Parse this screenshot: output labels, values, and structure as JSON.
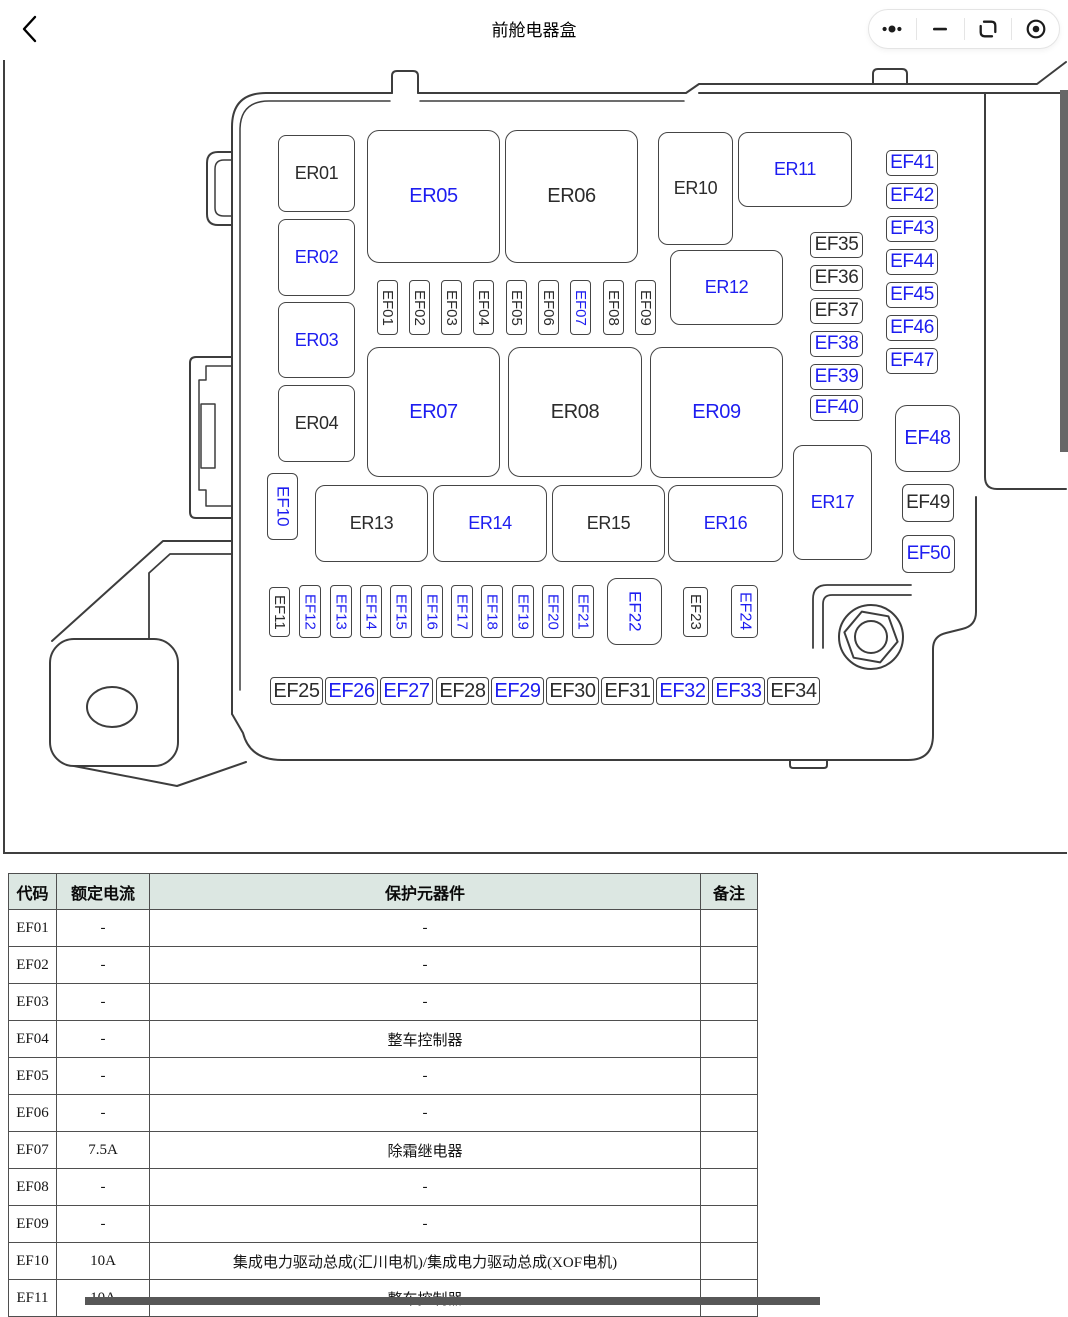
{
  "header": {
    "title": "前舱电器盒",
    "back_icon": "chevron-left",
    "capsule_icons": [
      "more-dots",
      "minimize",
      "restore-window",
      "circle-dot"
    ]
  },
  "colors": {
    "accent_blue": "#1d1df0",
    "label_black": "#2b2b2b",
    "outline": "#3d3d3d",
    "table_border": "#4f4f4f",
    "table_header_bg": "#dce7e2",
    "scrollbar": "#676767"
  },
  "diagram": {
    "description": "front-cabin fuse box line drawing with labeled relays and fuses",
    "component_fields": [
      "label",
      "x",
      "y",
      "w",
      "h",
      "color(b=blue,k=black)",
      "orientation(h/v)",
      "font_size",
      "corner_radius"
    ],
    "components": [
      [
        "ER01",
        278,
        135,
        77,
        77,
        "k",
        "h",
        18,
        8
      ],
      [
        "ER02",
        278,
        219,
        77,
        77,
        "b",
        "h",
        18,
        8
      ],
      [
        "ER03",
        278,
        302,
        77,
        76,
        "b",
        "h",
        18,
        8
      ],
      [
        "ER04",
        278,
        385,
        77,
        77,
        "k",
        "h",
        18,
        8
      ],
      [
        "ER05",
        367,
        130,
        133,
        133,
        "b",
        "h",
        20,
        12
      ],
      [
        "ER06",
        505,
        130,
        133,
        133,
        "k",
        "h",
        20,
        12
      ],
      [
        "ER07",
        367,
        347,
        133,
        130,
        "b",
        "h",
        20,
        12
      ],
      [
        "ER08",
        508,
        347,
        134,
        130,
        "k",
        "h",
        20,
        12
      ],
      [
        "ER09",
        650,
        347,
        133,
        131,
        "b",
        "h",
        20,
        12
      ],
      [
        "ER10",
        658,
        132,
        75,
        113,
        "k",
        "h",
        18,
        10
      ],
      [
        "ER11",
        738,
        132,
        114,
        75,
        "b",
        "h",
        18,
        10
      ],
      [
        "ER12",
        670,
        250,
        113,
        75,
        "b",
        "h",
        18,
        10
      ],
      [
        "ER13",
        315,
        485,
        113,
        77,
        "k",
        "h",
        18,
        10
      ],
      [
        "ER14",
        433,
        485,
        114,
        77,
        "b",
        "h",
        18,
        10
      ],
      [
        "ER15",
        552,
        485,
        113,
        77,
        "k",
        "h",
        18,
        10
      ],
      [
        "ER16",
        668,
        485,
        115,
        77,
        "b",
        "h",
        18,
        10
      ],
      [
        "ER17",
        793,
        445,
        79,
        115,
        "b",
        "h",
        18,
        10
      ],
      [
        "EF01",
        377,
        280,
        21,
        55,
        "k",
        "v",
        15,
        4
      ],
      [
        "EF02",
        409,
        280,
        21,
        55,
        "k",
        "v",
        15,
        4
      ],
      [
        "EF03",
        441,
        280,
        21,
        55,
        "k",
        "v",
        15,
        4
      ],
      [
        "EF04",
        473,
        280,
        21,
        55,
        "k",
        "v",
        15,
        4
      ],
      [
        "EF05",
        506,
        280,
        21,
        55,
        "k",
        "v",
        15,
        4
      ],
      [
        "EF06",
        538,
        280,
        21,
        55,
        "k",
        "v",
        15,
        4
      ],
      [
        "EF07",
        570,
        280,
        21,
        55,
        "b",
        "v",
        15,
        4
      ],
      [
        "EF08",
        603,
        280,
        21,
        55,
        "k",
        "v",
        15,
        4
      ],
      [
        "EF09",
        635,
        280,
        21,
        55,
        "k",
        "v",
        15,
        4
      ],
      [
        "EF10",
        267,
        473,
        31,
        67,
        "b",
        "v",
        17,
        6
      ],
      [
        "EF11",
        269,
        587,
        21,
        50,
        "k",
        "v",
        15,
        4
      ],
      [
        "EF12",
        299,
        585,
        22,
        53,
        "b",
        "v",
        15,
        4
      ],
      [
        "EF13",
        330,
        585,
        22,
        53,
        "b",
        "v",
        15,
        4
      ],
      [
        "EF14",
        360,
        585,
        22,
        53,
        "b",
        "v",
        15,
        4
      ],
      [
        "EF15",
        390,
        585,
        22,
        53,
        "b",
        "v",
        15,
        4
      ],
      [
        "EF16",
        421,
        585,
        22,
        53,
        "b",
        "v",
        15,
        4
      ],
      [
        "EF17",
        451,
        585,
        22,
        53,
        "b",
        "v",
        15,
        4
      ],
      [
        "EF18",
        481,
        585,
        22,
        53,
        "b",
        "v",
        15,
        4
      ],
      [
        "EF19",
        512,
        585,
        22,
        53,
        "b",
        "v",
        15,
        4
      ],
      [
        "EF20",
        542,
        585,
        22,
        53,
        "b",
        "v",
        15,
        4
      ],
      [
        "EF21",
        572,
        585,
        22,
        53,
        "b",
        "v",
        15,
        4
      ],
      [
        "EF22",
        607,
        578,
        55,
        67,
        "b",
        "v",
        17,
        10
      ],
      [
        "EF23",
        683,
        587,
        25,
        50,
        "k",
        "v",
        15,
        4
      ],
      [
        "EF24",
        731,
        585,
        27,
        53,
        "b",
        "v",
        16,
        5
      ],
      [
        "EF25",
        270,
        677,
        53,
        28,
        "k",
        "h",
        20,
        4
      ],
      [
        "EF26",
        325,
        677,
        53,
        28,
        "b",
        "h",
        20,
        4
      ],
      [
        "EF27",
        380,
        677,
        53,
        28,
        "b",
        "h",
        20,
        4
      ],
      [
        "EF28",
        436,
        677,
        53,
        28,
        "k",
        "h",
        20,
        4
      ],
      [
        "EF29",
        491,
        677,
        53,
        28,
        "b",
        "h",
        20,
        4
      ],
      [
        "EF30",
        546,
        677,
        53,
        28,
        "k",
        "h",
        20,
        4
      ],
      [
        "EF31",
        601,
        677,
        53,
        28,
        "k",
        "h",
        20,
        4
      ],
      [
        "EF32",
        656,
        677,
        53,
        28,
        "b",
        "h",
        20,
        4
      ],
      [
        "EF33",
        712,
        677,
        53,
        28,
        "b",
        "h",
        20,
        4
      ],
      [
        "EF34",
        767,
        677,
        53,
        28,
        "k",
        "h",
        20,
        4
      ],
      [
        "EF35",
        810,
        232,
        53,
        26,
        "k",
        "h",
        19,
        5
      ],
      [
        "EF36",
        810,
        265,
        53,
        26,
        "k",
        "h",
        19,
        5
      ],
      [
        "EF37",
        810,
        298,
        53,
        26,
        "k",
        "h",
        19,
        5
      ],
      [
        "EF38",
        810,
        331,
        53,
        26,
        "b",
        "h",
        19,
        5
      ],
      [
        "EF39",
        810,
        364,
        53,
        26,
        "b",
        "h",
        19,
        5
      ],
      [
        "EF40",
        810,
        395,
        53,
        26,
        "b",
        "h",
        19,
        5
      ],
      [
        "EF41",
        886,
        150,
        52,
        26,
        "b",
        "h",
        19,
        5
      ],
      [
        "EF42",
        886,
        183,
        52,
        26,
        "b",
        "h",
        19,
        5
      ],
      [
        "EF43",
        886,
        216,
        52,
        26,
        "b",
        "h",
        19,
        5
      ],
      [
        "EF44",
        886,
        249,
        52,
        26,
        "b",
        "h",
        19,
        5
      ],
      [
        "EF45",
        886,
        282,
        52,
        26,
        "b",
        "h",
        19,
        5
      ],
      [
        "EF46",
        886,
        315,
        52,
        26,
        "b",
        "h",
        19,
        5
      ],
      [
        "EF47",
        886,
        348,
        52,
        26,
        "b",
        "h",
        19,
        5
      ],
      [
        "EF48",
        895,
        405,
        65,
        67,
        "b",
        "h",
        20,
        12
      ],
      [
        "EF49",
        902,
        484,
        52,
        38,
        "k",
        "h",
        19,
        6
      ],
      [
        "EF50",
        902,
        535,
        53,
        38,
        "b",
        "h",
        19,
        6
      ]
    ]
  },
  "table": {
    "headers": [
      "代码",
      "额定电流",
      "保护元器件",
      "备注"
    ],
    "rows": [
      [
        "EF01",
        "-",
        "-",
        ""
      ],
      [
        "EF02",
        "-",
        "-",
        ""
      ],
      [
        "EF03",
        "-",
        "-",
        ""
      ],
      [
        "EF04",
        "-",
        "整车控制器",
        ""
      ],
      [
        "EF05",
        "-",
        "-",
        ""
      ],
      [
        "EF06",
        "-",
        "-",
        ""
      ],
      [
        "EF07",
        "7.5A",
        "除霜继电器",
        ""
      ],
      [
        "EF08",
        "-",
        "-",
        ""
      ],
      [
        "EF09",
        "-",
        "-",
        ""
      ],
      [
        "EF10",
        "10A",
        "集成电力驱动总成(汇川电机)/集成电力驱动总成(XOF电机)",
        ""
      ],
      [
        "EF11",
        "10A",
        "整车控制器",
        ""
      ]
    ]
  }
}
